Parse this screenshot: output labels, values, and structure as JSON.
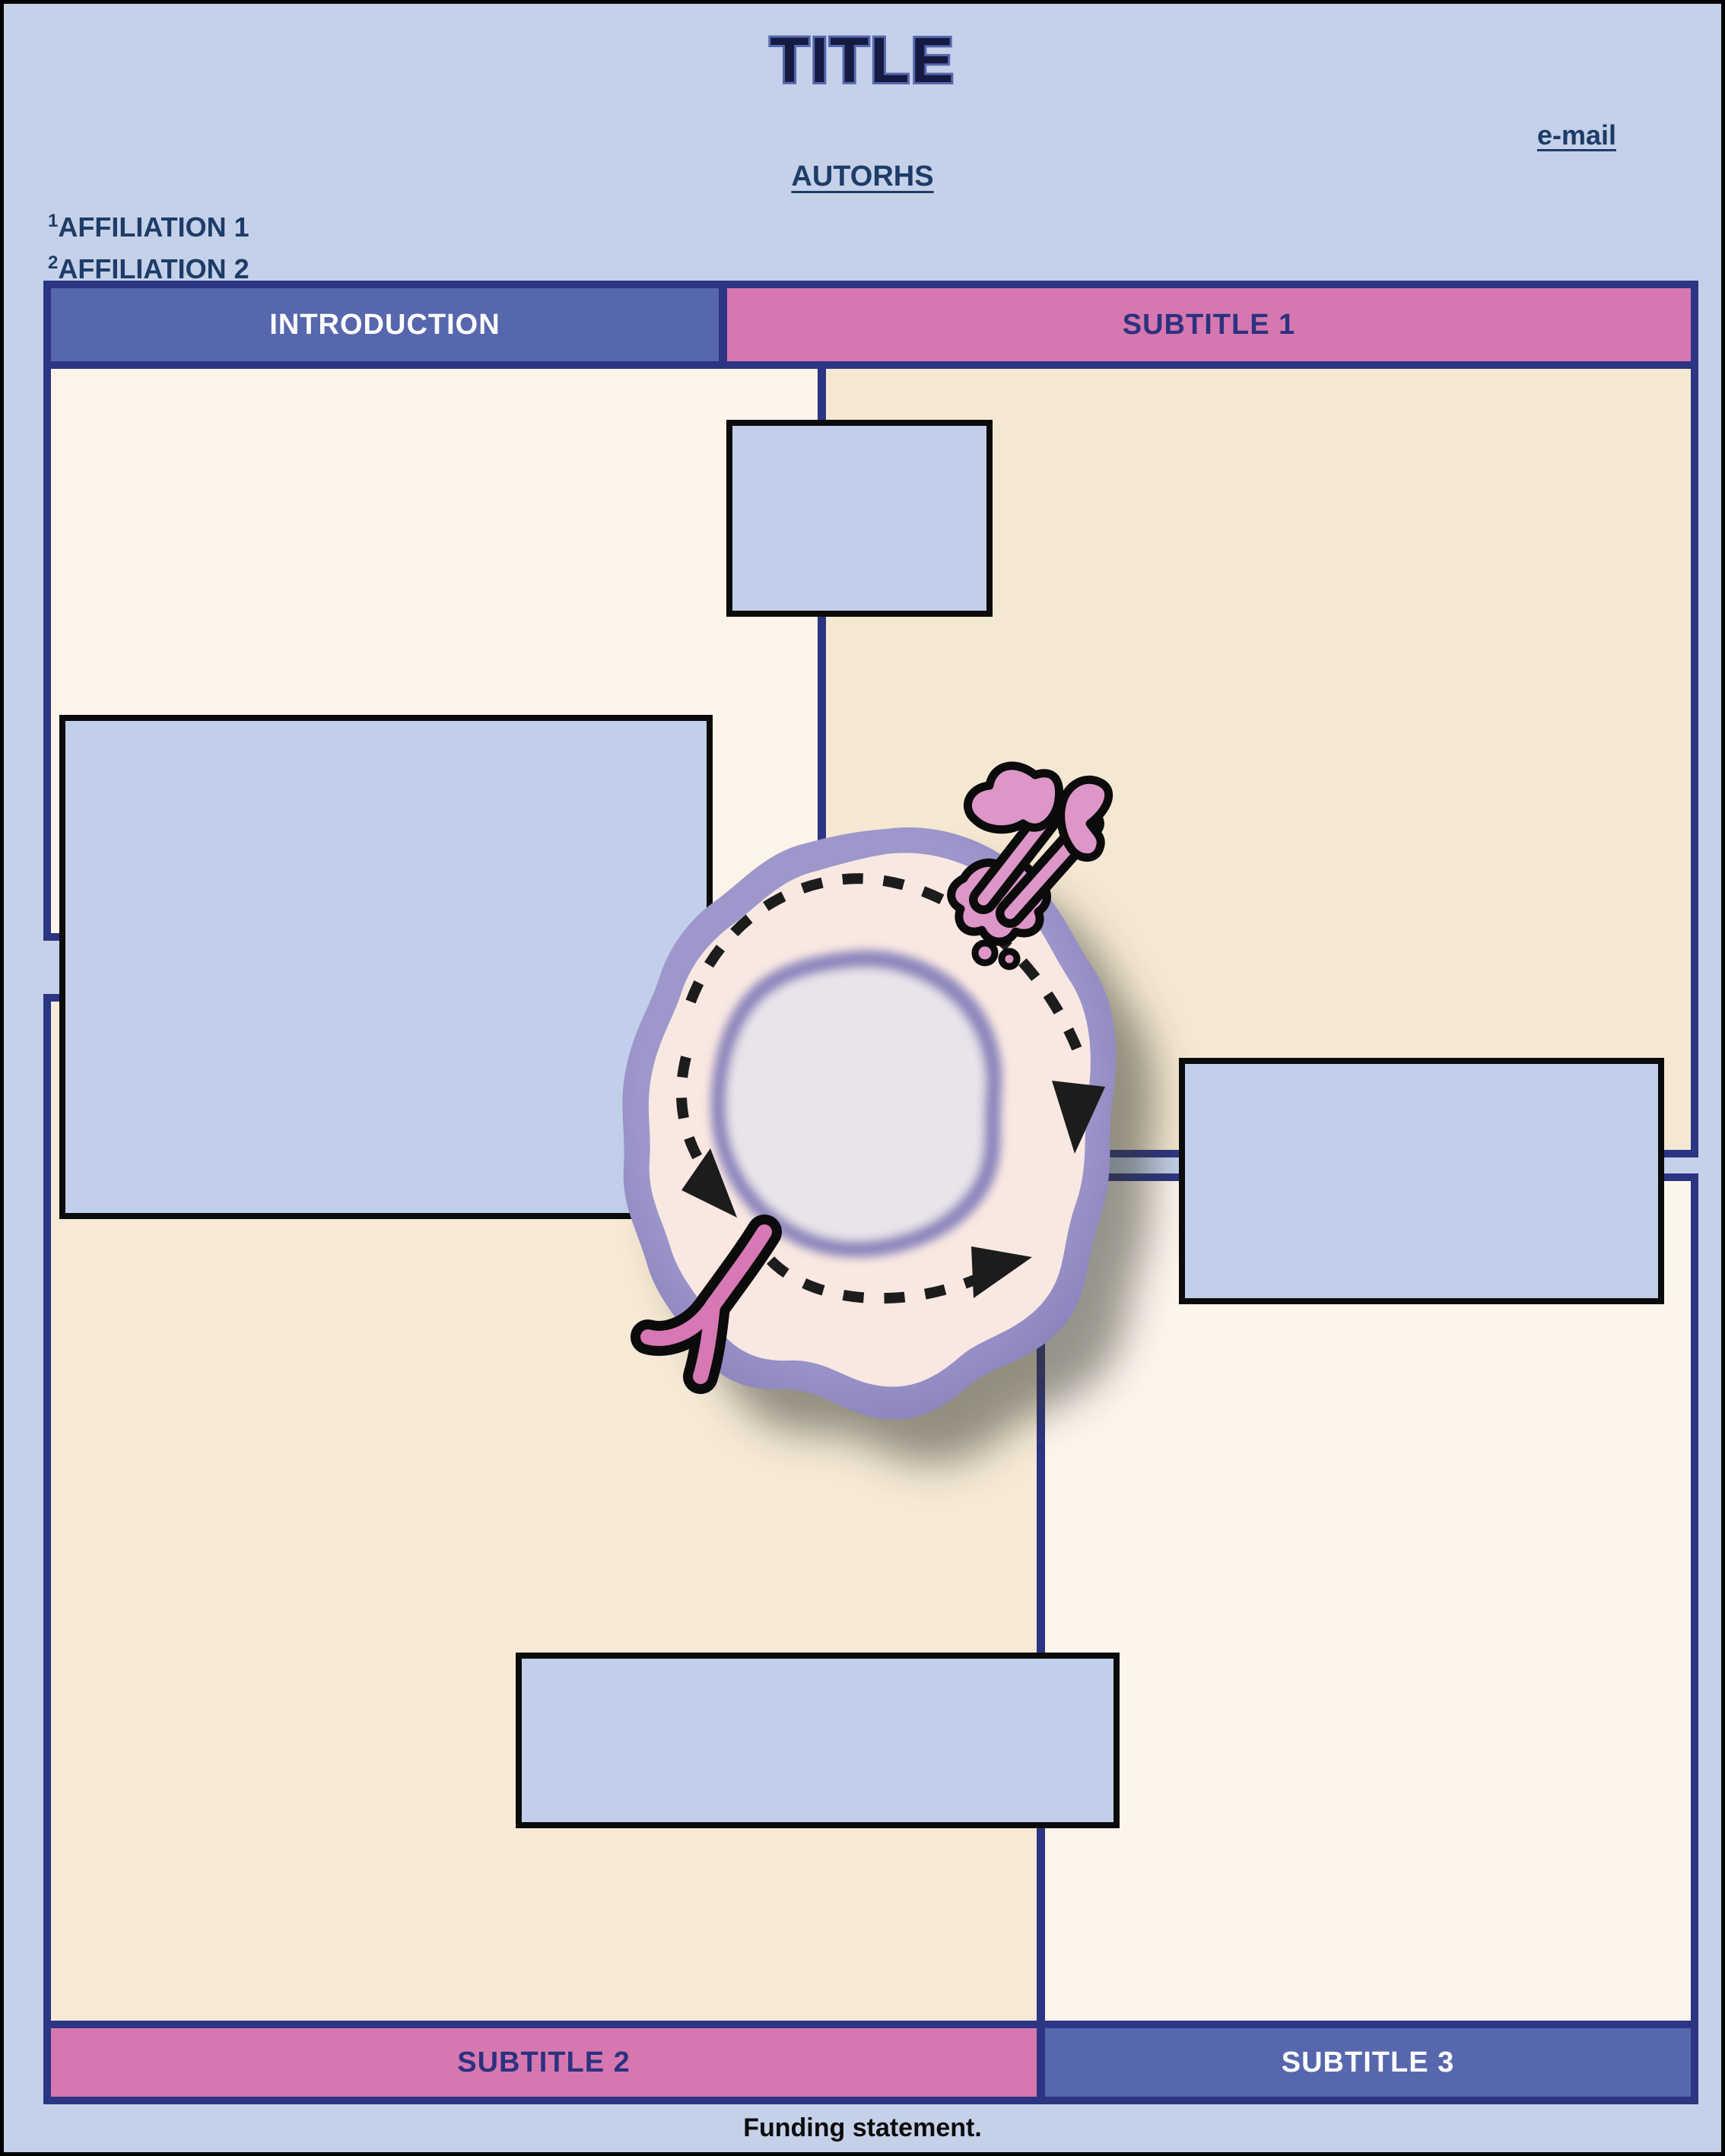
{
  "poster": {
    "title": "TITLE",
    "email_link": "e-mail",
    "authors": "AUTORHS",
    "affiliations": [
      {
        "sup": "1",
        "name": "AFFILIATION 1"
      },
      {
        "sup": "2",
        "name": "AFFILIATION 2"
      }
    ],
    "funding": "Funding statement."
  },
  "sections": {
    "introduction": {
      "label": "INTRODUCTION"
    },
    "subtitle1": {
      "label": "SUBTITLE 1"
    },
    "subtitle2": {
      "label": "SUBTITLE 2"
    },
    "subtitle3": {
      "label": "SUBTITLE 3"
    }
  },
  "figure": {
    "type": "cell-diagram",
    "icons": [
      "cell-membrane",
      "cell-cytoplasm",
      "cell-nucleus",
      "circulation-dashed-arrow",
      "membrane-receptor-icon",
      "antibody-receptor-icon"
    ]
  },
  "colors": {
    "background": "#c5d1e9",
    "border_navy": "#2c3583",
    "bar_purple": "#5767ad",
    "bar_pink": "#d678af",
    "panel_cream": "#fdf4e9",
    "panel_beige": "#f5e8d2",
    "placeholder_blue": "#c2cfea",
    "text_navy": "#1d3c68",
    "subtitle_text_navy": "#2b3280",
    "membrane_purple": "#948dc3",
    "cytoplasm_pink": "#f9e8e1",
    "nucleus_fill": "#e9e3ea",
    "nucleus_rim": "#8d86bd",
    "receptor_pink": "#d98bbd",
    "shadow": "#30352b"
  }
}
